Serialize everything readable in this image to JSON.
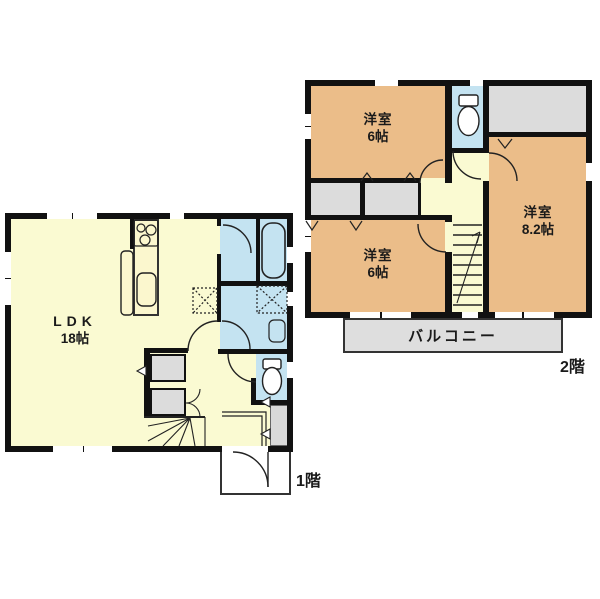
{
  "plan_title": "2-story house floor plan",
  "colors": {
    "wall": "#111111",
    "ldk_floor": "#FAFAD2",
    "bedroom_floor": "#EBBD89",
    "wet_area_floor": "#C4E3F1",
    "closet_floor": "#DCDCDC",
    "balcony_floor": "#DEDEDE",
    "line": "#222222"
  },
  "floor1": {
    "floor_label": "1階",
    "rooms": {
      "ldk": {
        "name": "LDK",
        "size": "18帖"
      }
    },
    "fixtures": [
      "stove-icon",
      "kitchen-sink-icon",
      "island-counter-icon",
      "bathtub-icon",
      "vanity-sink-icon",
      "toilet-icon",
      "washer-space-icon",
      "fridge-space-icon",
      "winder-stairs-icon",
      "entry-door-icon"
    ]
  },
  "floor2": {
    "floor_label": "2階",
    "rooms": {
      "bedroom_top_left": {
        "name": "洋室",
        "size": "6帖"
      },
      "bedroom_bottom_left": {
        "name": "洋室",
        "size": "6帖"
      },
      "bedroom_right": {
        "name": "洋室",
        "size": "8.2帖"
      }
    },
    "balcony_label": "バルコニー",
    "fixtures": [
      "toilet-icon",
      "stairs-icon"
    ]
  }
}
